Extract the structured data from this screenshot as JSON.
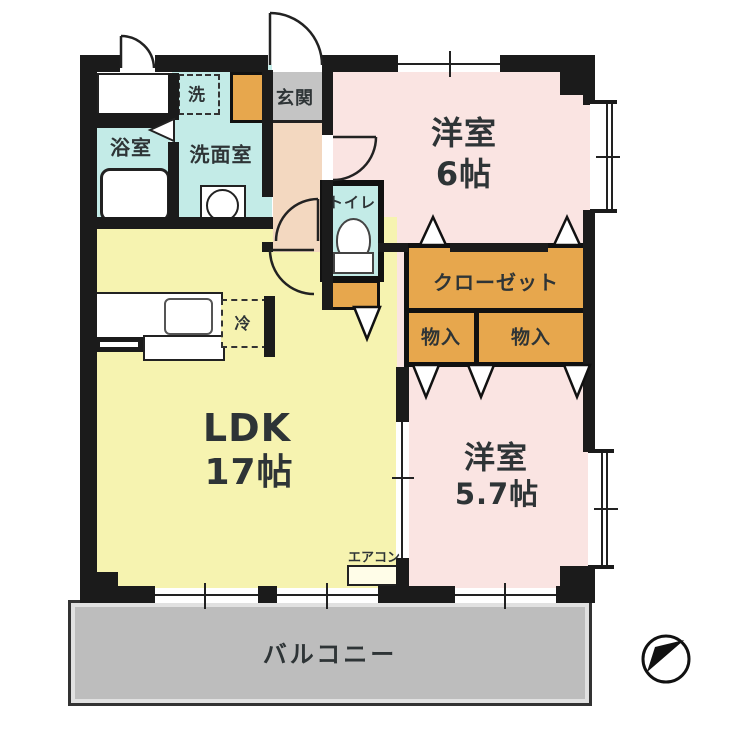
{
  "title": "apartment-floor-plan",
  "rooms": {
    "bath": "浴室",
    "laundry": "洗",
    "washroom": "洗面室",
    "entrance": "玄関",
    "toilet": "トイレ",
    "western6": {
      "name": "洋室",
      "size": "6帖"
    },
    "closet": "クローゼット",
    "storage_left": "物入",
    "storage_right": "物入",
    "western57": {
      "name": "洋室",
      "size": "5.7帖"
    },
    "ldk": {
      "name": "LDK",
      "size": "17帖"
    },
    "fridge": "冷",
    "aircon": "エアコン",
    "balcony": "バルコニー"
  },
  "colors": {
    "wall": "#1b1b1b",
    "ink": "#2e3436",
    "pink": "#fae4e2",
    "yellow": "#f6f3b0",
    "cyan": "#c3ebe7",
    "orange": "#e7a74d",
    "peach": "#f3d8c0",
    "genkan": "#c4c4c4",
    "balcony_gray": "#bdbdbd"
  }
}
